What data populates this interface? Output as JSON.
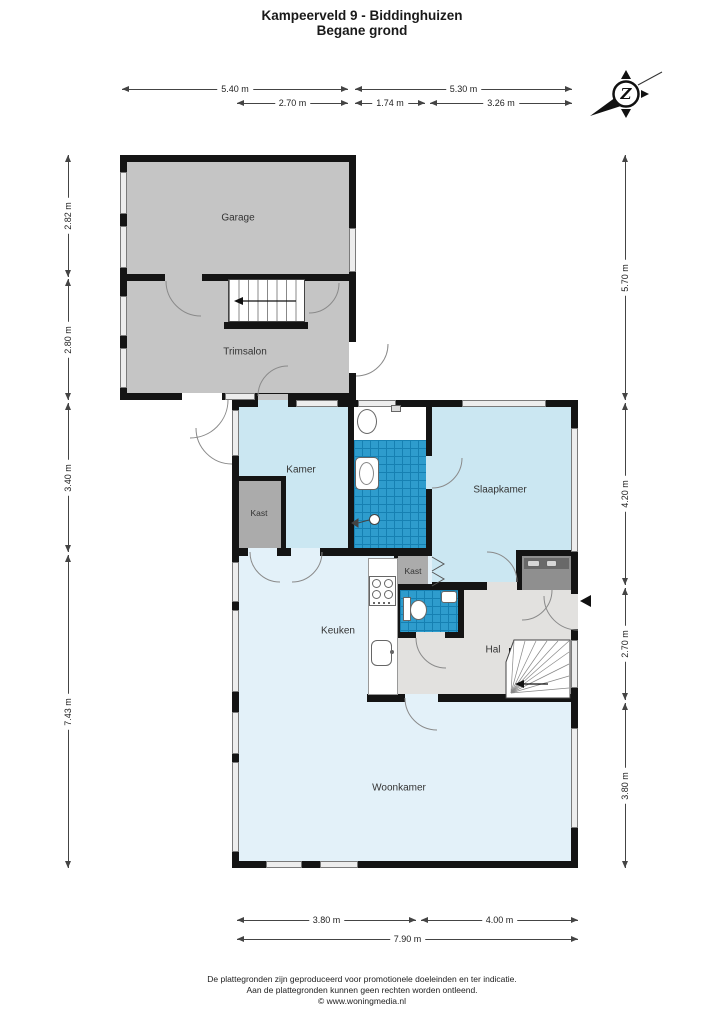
{
  "title": {
    "line1": "Kampeerveld 9 - Biddinghuizen",
    "line2": "Begane grond"
  },
  "compass": {
    "letter": "Z"
  },
  "rooms": {
    "garage": "Garage",
    "trimsalon": "Trimsalon",
    "kamer": "Kamer",
    "kast_kamer": "Kast",
    "slaapkamer": "Slaapkamer",
    "kast_hal": "Kast",
    "keuken": "Keuken",
    "hal": "Hal",
    "woonkamer": "Woonkamer"
  },
  "dimensions": {
    "top_row1": [
      "5.40 m",
      "5.30 m"
    ],
    "top_row2": [
      "2.70 m",
      "1.74 m",
      "3.26 m"
    ],
    "left": [
      "2.82 m",
      "2.80 m",
      "3.40 m",
      "7.43 m"
    ],
    "right": [
      "5.70 m",
      "4.20 m",
      "2.70 m",
      "3.80 m"
    ],
    "bottom_row1": [
      "3.80 m",
      "4.00 m"
    ],
    "bottom_row2": [
      "7.90 m"
    ]
  },
  "footer": {
    "line1": "De plattegronden zijn geproduceerd voor promotionele doeleinden en ter indicatie.",
    "line2": "Aan de plattegronden kunnen geen rechten worden ontleend.",
    "line3": "© www.woningmedia.nl"
  },
  "colors": {
    "wall": "#141414",
    "room_gray": "#c5c5c5",
    "room_blue": "#cbe7f2",
    "room_pale_blue": "#e3f1f9",
    "hall_gray": "#e2e1df",
    "closet_gray": "#ababab",
    "tile_blue": "#2e9ccd",
    "tile_grid": "#1680b2"
  }
}
